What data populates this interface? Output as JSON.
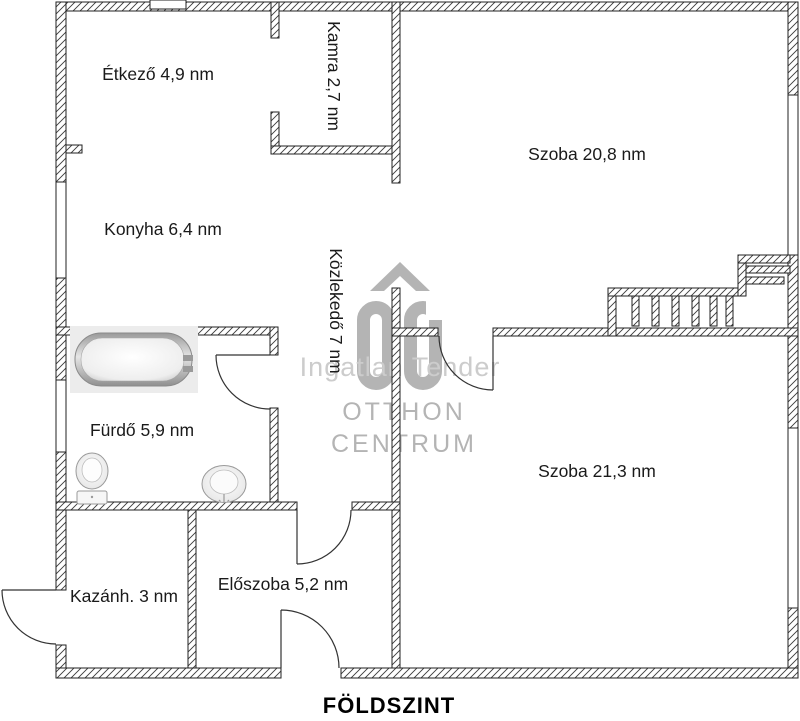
{
  "title": "FÖLDSZINT",
  "rooms": [
    {
      "id": "etkezo",
      "label": "Étkező 4,9 nm"
    },
    {
      "id": "kamra",
      "label": "Kamra 2,7 nm"
    },
    {
      "id": "szoba-felso",
      "label": "Szoba 20,8 nm"
    },
    {
      "id": "konyha",
      "label": "Konyha 6,4 nm"
    },
    {
      "id": "kozlekedo",
      "label": "Közlekedő 7 nm"
    },
    {
      "id": "furdo",
      "label": "Fürdő 5,9 nm"
    },
    {
      "id": "szoba-also",
      "label": "Szoba 21,3 nm"
    },
    {
      "id": "kazanhaz",
      "label": "Kazánh. 3 nm"
    },
    {
      "id": "eloszoba",
      "label": "Előszoba 5,2 nm"
    }
  ],
  "watermark": {
    "logo": "OC",
    "tagline": "Ingatlan Tender",
    "brand_line1": "OTTHON",
    "brand_line2": "CENTRUM"
  },
  "colors": {
    "wall_line": "#222222",
    "watermark_gray": "#b4b4b4",
    "watermark_light": "#cccccc",
    "label_text": "#1a1a1a"
  }
}
